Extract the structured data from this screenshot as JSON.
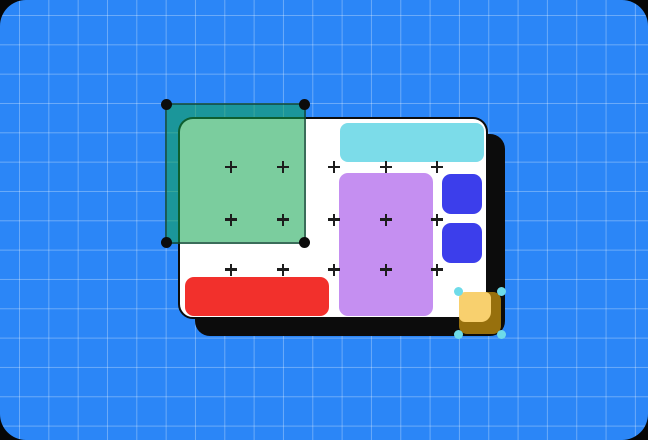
{
  "scene": {
    "title": "Design-tool canvas illustration",
    "artboard": {
      "name": "artboard",
      "selected_shapes_count": 2
    }
  },
  "colors": {
    "outer_bg": "#060606",
    "workspace_bg": "#2b86f7",
    "grid_line": "rgba(255,255,255,0.30)",
    "artboard_bg": "#ffffff",
    "artboard_border": "#0c0c0c",
    "artboard_shadow": "#0c0c0c",
    "selection_fill": "rgba(14,164,78,0.55)",
    "selection_border": "rgba(16,45,45,0.60)",
    "selection_handle_dark": "#0c0c0c",
    "selection_handle_cyan": "#6edbe9",
    "shape_cyan": "#7cdce9",
    "shape_purple": "#c58ff1",
    "shape_blue": "#3c3eeb",
    "shape_red": "#f2302c",
    "shape_yellow": "#f8d06e",
    "shape_yellow_shadow": "#97700d",
    "plus_mark": "#1d1d1d"
  },
  "shapes": [
    {
      "name": "green-rectangle",
      "state": "selected",
      "color_key": "selection_fill",
      "handles": "black-dots"
    },
    {
      "name": "cyan-bar",
      "state": "normal",
      "color_key": "shape_cyan"
    },
    {
      "name": "purple-rectangle",
      "state": "normal",
      "color_key": "shape_purple"
    },
    {
      "name": "blue-square-top",
      "state": "normal",
      "color_key": "shape_blue"
    },
    {
      "name": "blue-square-bottom",
      "state": "normal",
      "color_key": "shape_blue"
    },
    {
      "name": "red-bar",
      "state": "normal",
      "color_key": "shape_red"
    },
    {
      "name": "yellow-square",
      "state": "selected",
      "color_key": "shape_yellow",
      "handles": "cyan-dots"
    }
  ],
  "canvas_markers": {
    "glyph": "+",
    "columns_x": [
      231,
      283,
      334,
      386,
      437
    ],
    "rows_y": [
      167,
      219.5,
      269.5
    ]
  }
}
